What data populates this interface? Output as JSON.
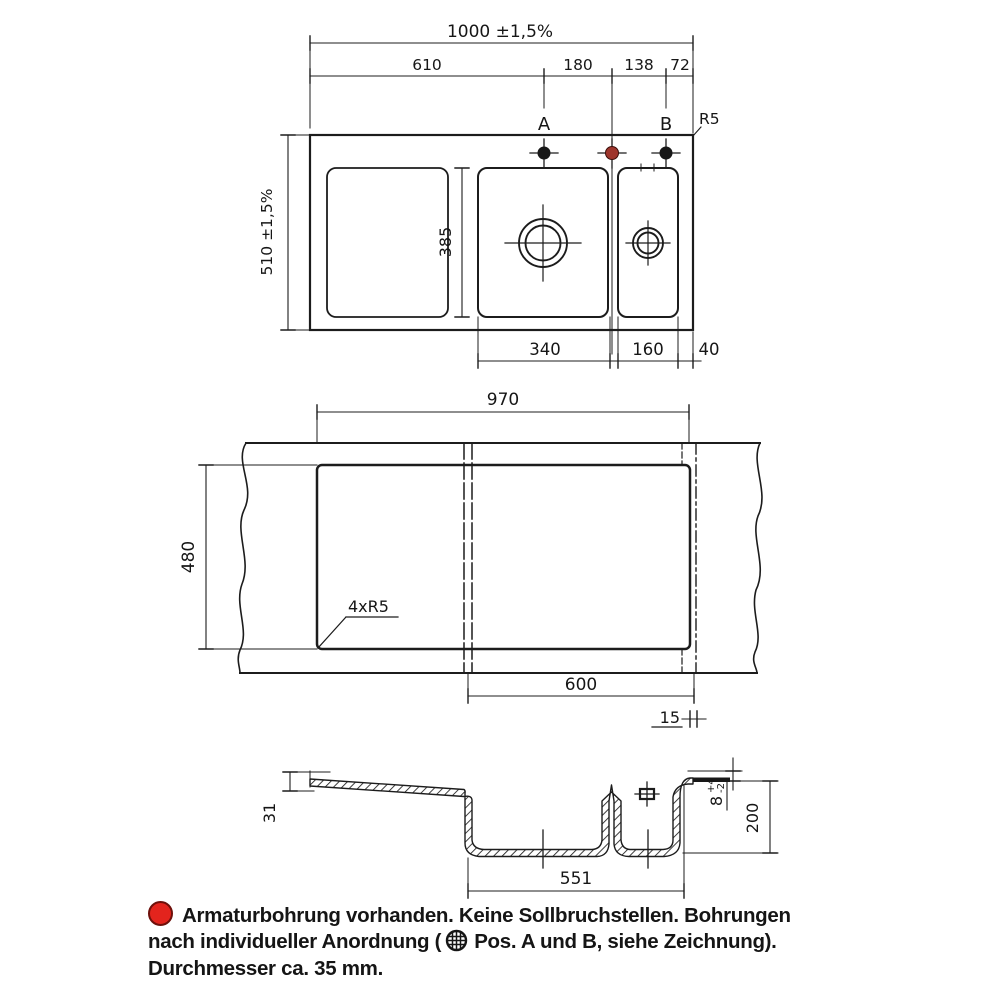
{
  "colors": {
    "line": "#1c1c1c",
    "footer_dot_red": "#e3241d",
    "faucet_hole_red": "#9e352c"
  },
  "top_view": {
    "dim_total_width": "1000 ±1,5%",
    "dim_left_to_a": "610",
    "dim_a_to_red": "180",
    "dim_red_to_b": "138",
    "dim_b_to_edge": "72",
    "hole_a": "A",
    "hole_b": "B",
    "corner_radius": "R5",
    "dim_total_depth": "510 ±1,5%",
    "dim_inner_depth": "385",
    "dim_main_bowl": "340",
    "dim_small_bowl": "160",
    "dim_right_margin": "40"
  },
  "cutout_view": {
    "dim_width": "970",
    "dim_depth": "480",
    "corner_radius": "4xR5",
    "dim_cabinet": "600",
    "dim_offset": "15"
  },
  "section_view": {
    "dim_rim_drop": "31",
    "dim_bowl_span": "551",
    "dim_rim_height": "8",
    "tol_plus": "+4",
    "tol_minus": "-2",
    "dim_depth": "200"
  },
  "footer": {
    "line1": "Armaturbohrung vorhanden. Keine Sollbruchstellen. Bohrungen",
    "line2_before_icon": "nach individueller Anordnung (",
    "line2_after_icon": "Pos. A und B, siehe Zeichnung).",
    "line3": "Durchmesser ca. 35 mm."
  }
}
